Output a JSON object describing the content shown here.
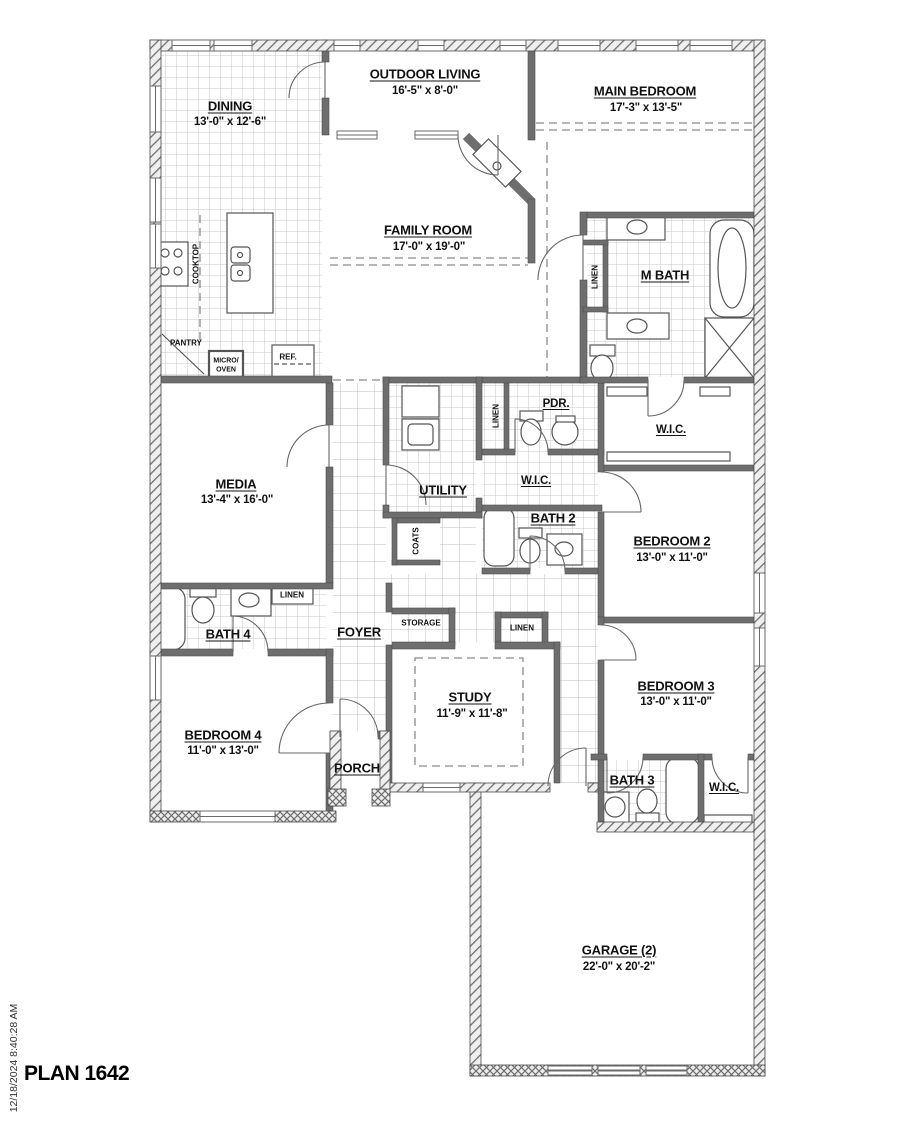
{
  "plan": {
    "title": "PLAN 1642",
    "timestamp": "12/18/2024 8:40:28 AM"
  },
  "rooms": {
    "dining": {
      "name": "DINING",
      "dims": "13'-0\" x 12'-6\""
    },
    "outdoor_living": {
      "name": "OUTDOOR LIVING",
      "dims": "16'-5\" x 8'-0\""
    },
    "main_bedroom": {
      "name": "MAIN BEDROOM",
      "dims": "17'-3\" x 13'-5\""
    },
    "family_room": {
      "name": "FAMILY ROOM",
      "dims": "17'-0\" x 19'-0\""
    },
    "m_bath": {
      "name": "M BATH"
    },
    "media": {
      "name": "MEDIA",
      "dims": "13'-4\" x 16'-0\""
    },
    "utility": {
      "name": "UTILITY"
    },
    "pdr": {
      "name": "PDR."
    },
    "wic_hall": {
      "name": "W.I.C."
    },
    "wic_main": {
      "name": "W.I.C."
    },
    "bath2": {
      "name": "BATH 2"
    },
    "bedroom2": {
      "name": "BEDROOM 2",
      "dims": "13'-0\" x 11'-0\""
    },
    "bath4": {
      "name": "BATH 4"
    },
    "foyer": {
      "name": "FOYER"
    },
    "study": {
      "name": "STUDY",
      "dims": "11'-9\" x 11'-8\""
    },
    "bedroom3": {
      "name": "BEDROOM 3",
      "dims": "13'-0\" x 11'-0\""
    },
    "bedroom4": {
      "name": "BEDROOM 4",
      "dims": "11'-0\" x 13'-0\""
    },
    "porch": {
      "name": "PORCH"
    },
    "bath3": {
      "name": "BATH 3"
    },
    "wic_bed3": {
      "name": "W.I.C."
    },
    "garage": {
      "name": "GARAGE (2)",
      "dims": "22'-0\" x 20'-2\""
    }
  },
  "labels": {
    "cooktop": "COOKTOP",
    "pantry": "PANTRY",
    "micro_oven_line1": "MICRO/",
    "micro_oven_line2": "OVEN",
    "ref": "REF.",
    "linen_mbath": "LINEN",
    "linen_pdr": "LINEN",
    "coats": "COATS",
    "linen_bath4": "LINEN",
    "storage": "STORAGE",
    "linen_study": "LINEN"
  }
}
